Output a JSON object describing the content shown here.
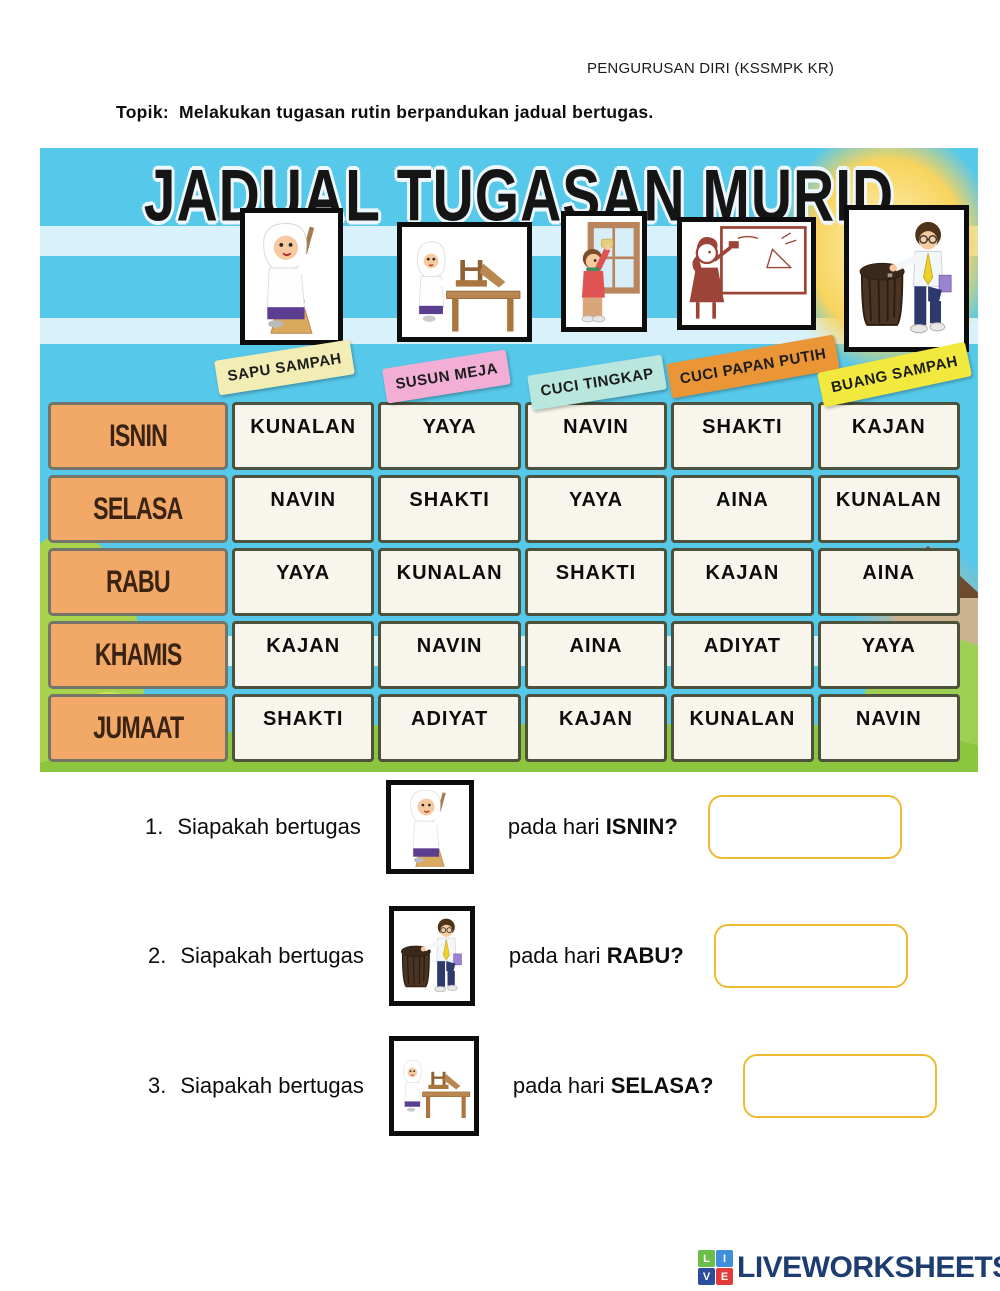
{
  "header": {
    "doc_label": "PENGURUSAN DIRI (KSSMPK KR)",
    "topic_label": "Topik:",
    "topic_text": "Melakukan tugasan rutin berpandukan jadual bertugas."
  },
  "poster": {
    "title": "JADUAL TUGASAN MURID",
    "task_tags": [
      {
        "label": "SAPU SAMPAH",
        "color": "#f1edb5"
      },
      {
        "label": "SUSUN MEJA",
        "color": "#f3aed6"
      },
      {
        "label": "CUCI TINGKAP",
        "color": "#b9e7de"
      },
      {
        "label": "CUCI PAPAN PUTIH",
        "color": "#ea9636"
      },
      {
        "label": "BUANG SAMPAH",
        "color": "#f2e93e"
      }
    ],
    "images": [
      {
        "icon": "girl-sweeping-image",
        "task": "SAPU SAMPAH"
      },
      {
        "icon": "girl-arranging-table-image",
        "task": "SUSUN MEJA"
      },
      {
        "icon": "boy-cleaning-window-image",
        "task": "CUCI TINGKAP"
      },
      {
        "icon": "girl-cleaning-whiteboard-image",
        "task": "CUCI PAPAN PUTIH"
      },
      {
        "icon": "boy-throwing-trash-image",
        "task": "BUANG SAMPAH"
      }
    ],
    "days": [
      "ISNIN",
      "SELASA",
      "RABU",
      "KHAMIS",
      "JUMAAT"
    ],
    "schedule": [
      [
        "KUNALAN",
        "YAYA",
        "NAVIN",
        "SHAKTI",
        "KAJAN"
      ],
      [
        "NAVIN",
        "SHAKTI",
        "YAYA",
        "AINA",
        "KUNALAN"
      ],
      [
        "YAYA",
        "KUNALAN",
        "SHAKTI",
        "KAJAN",
        "AINA"
      ],
      [
        "KAJAN",
        "NAVIN",
        "AINA",
        "ADIYAT",
        "YAYA"
      ],
      [
        "SHAKTI",
        "ADIYAT",
        "KAJAN",
        "KUNALAN",
        "NAVIN"
      ]
    ],
    "colors": {
      "day_cell": "#f2a968",
      "data_cell": "#f8f5ec",
      "sky": "#56c8ea",
      "grass": "#8cc63e"
    }
  },
  "questions": [
    {
      "number": "1.",
      "pre": "Siapakah bertugas",
      "mid": "pada hari ",
      "day": "ISNIN",
      "mark": "?",
      "icon": "girl-sweeping-image",
      "answer_value": ""
    },
    {
      "number": "2.",
      "pre": "Siapakah bertugas",
      "mid": "pada hari ",
      "day": "RABU",
      "mark": "?",
      "icon": "boy-throwing-trash-image",
      "answer_value": ""
    },
    {
      "number": "3.",
      "pre": "Siapakah bertugas",
      "mid": "pada hari ",
      "day": "SELASA",
      "mark": "?",
      "icon": "girl-arranging-table-image",
      "answer_value": ""
    }
  ],
  "footer": {
    "brand": "LIVEWORKSHEETS",
    "brand_color": "#1d3c6f",
    "logo_letters": [
      "L",
      "I",
      "V",
      "E"
    ],
    "logo_colors": [
      "#6abf4b",
      "#3f8fdd",
      "#2b4d9b",
      "#e23b3b"
    ]
  }
}
